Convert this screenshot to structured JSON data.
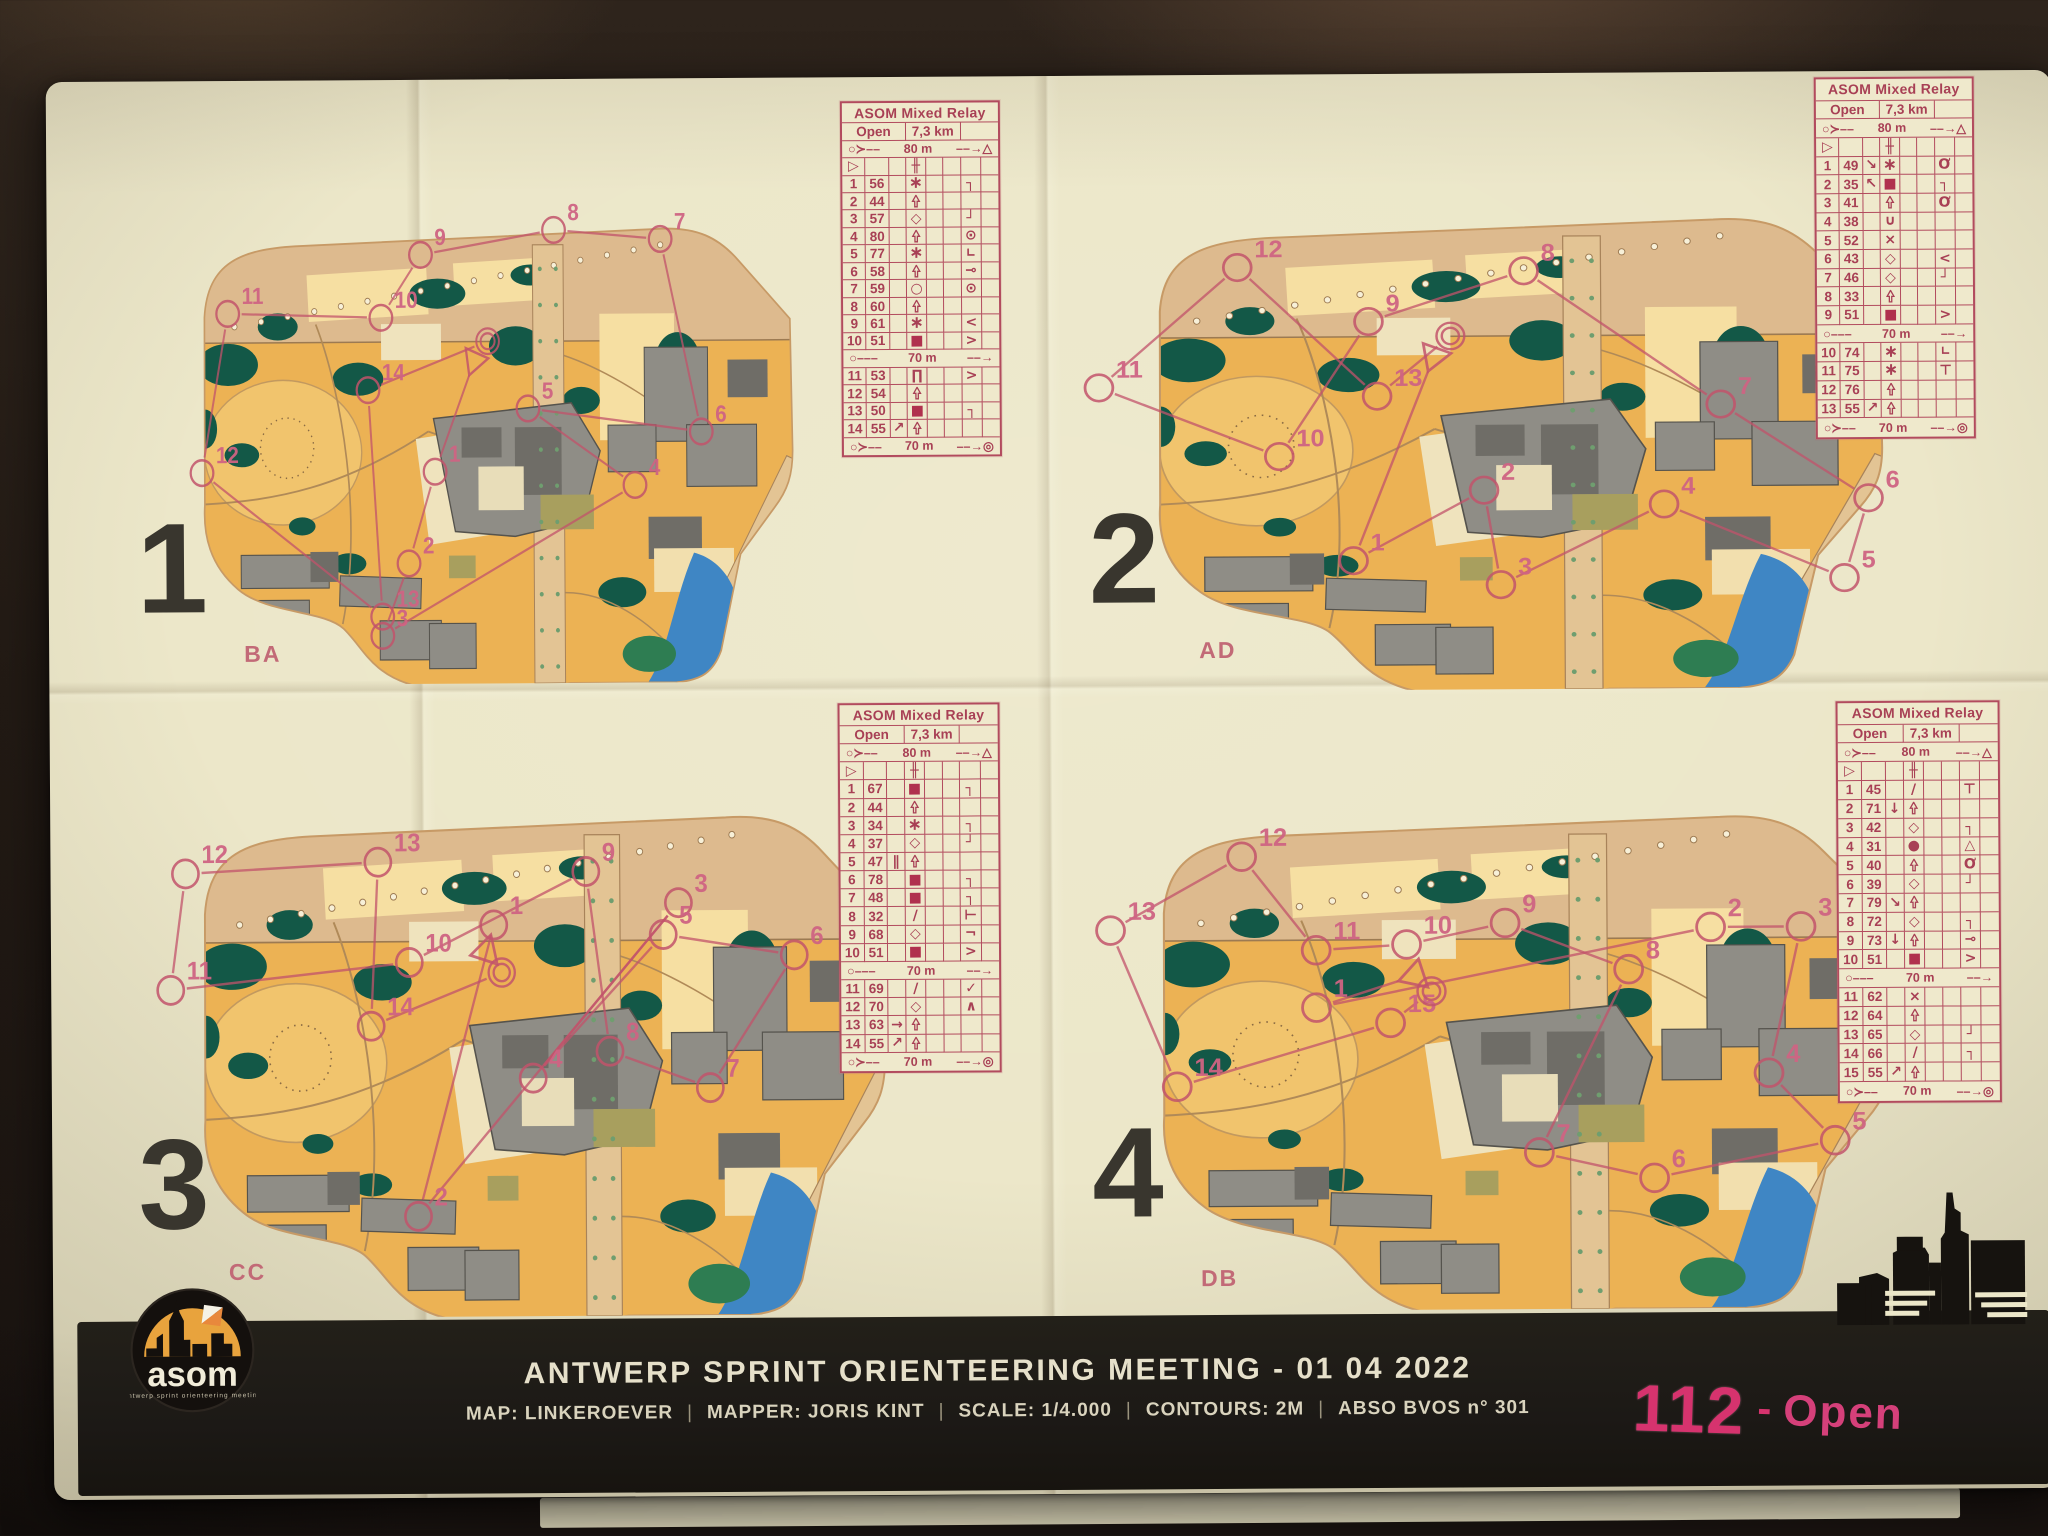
{
  "colors": {
    "course_magenta": "#c2536b",
    "table_magenta": "#a84055",
    "bib_pink": "#d6336e",
    "paper_cream": "#ece7c9",
    "map_orange": "#ecb254",
    "map_green": "#135847",
    "building_gray": "#8f8d86",
    "water_blue": "#3f86c4",
    "footer_black": "#1c1916"
  },
  "event": {
    "title_line": "ANTWERP SPRINT ORIENTEERING MEETING - 01 04 2022",
    "meta_items": [
      "MAP: LINKEROEVER",
      "MAPPER: JORIS KINT",
      "SCALE: 1/4.000",
      "CONTOURS: 2M",
      "ABSO BVOS n° 301"
    ],
    "meta_separator": "|",
    "bib_number": "112",
    "bib_separator": "-",
    "bib_class": "Open",
    "logo_text": "asom",
    "logo_tagline": "antwerp sprint orienteering meeting"
  },
  "relay": {
    "table_title": "ASOM Mixed Relay",
    "class_name": "Open",
    "course_length": "7,3 km",
    "start_distance": "80 m",
    "exchange_distance": "70 m",
    "finish_distance": "70 m"
  },
  "panels": [
    {
      "leg": "1",
      "map_code": "BA",
      "divider_after": 10,
      "controls": [
        {
          "n": "1",
          "code": "56",
          "d": "star",
          "g": "corner-ne"
        },
        {
          "n": "2",
          "code": "44",
          "d": "tree"
        },
        {
          "n": "3",
          "code": "57",
          "d": "diamond",
          "g": "corner-se"
        },
        {
          "n": "4",
          "code": "80",
          "d": "tree",
          "g": "circle-tick"
        },
        {
          "n": "5",
          "code": "77",
          "d": "star",
          "g": "corner"
        },
        {
          "n": "6",
          "code": "58",
          "d": "tree",
          "g": "circle-line"
        },
        {
          "n": "7",
          "code": "59",
          "d": "circle",
          "g": "circle-tick"
        },
        {
          "n": "8",
          "code": "60",
          "d": "tree"
        },
        {
          "n": "9",
          "code": "61",
          "d": "star",
          "g": "bend-w"
        },
        {
          "n": "10",
          "code": "51",
          "d": "square",
          "g": "bend-e"
        },
        {
          "n": "11",
          "code": "53",
          "d": "canopy",
          "g": "bend-e"
        },
        {
          "n": "12",
          "code": "54",
          "d": "tree"
        },
        {
          "n": "13",
          "code": "50",
          "d": "square",
          "g": "corner-ne"
        },
        {
          "n": "14",
          "code": "55",
          "c": "arrow-ne",
          "d": "tree"
        }
      ],
      "course": {
        "start": [
          50,
          33
        ],
        "finish": [
          52,
          29
        ],
        "points": [
          [
            1,
            44,
            56
          ],
          [
            2,
            40,
            75
          ],
          [
            3,
            36,
            90
          ],
          [
            4,
            74,
            59
          ],
          [
            5,
            58,
            43
          ],
          [
            6,
            84,
            48
          ],
          [
            7,
            78,
            8
          ],
          [
            8,
            62,
            6
          ],
          [
            9,
            42,
            11
          ],
          [
            10,
            36,
            24
          ],
          [
            11,
            13,
            23
          ],
          [
            12,
            9,
            56
          ],
          [
            13,
            36,
            86
          ],
          [
            14,
            34,
            39
          ]
        ]
      }
    },
    {
      "leg": "2",
      "map_code": "AD",
      "divider_after": 9,
      "controls": [
        {
          "n": "1",
          "code": "49",
          "c": "arrow-se",
          "d": "star",
          "g": "circle-tail"
        },
        {
          "n": "2",
          "code": "35",
          "c": "arrow-nw",
          "d": "square",
          "g": "corner-ne"
        },
        {
          "n": "3",
          "code": "41",
          "d": "tree",
          "g": "circle-tail"
        },
        {
          "n": "4",
          "code": "38",
          "d": "semicircle"
        },
        {
          "n": "5",
          "code": "52",
          "d": "cross"
        },
        {
          "n": "6",
          "code": "43",
          "d": "diamond",
          "g": "bend-w"
        },
        {
          "n": "7",
          "code": "46",
          "d": "diamond",
          "g": "corner-se"
        },
        {
          "n": "8",
          "code": "33",
          "d": "tree"
        },
        {
          "n": "9",
          "code": "51",
          "d": "square",
          "g": "bend-e"
        },
        {
          "n": "10",
          "code": "74",
          "d": "star",
          "g": "corner"
        },
        {
          "n": "11",
          "code": "75",
          "d": "star",
          "g": "t-n"
        },
        {
          "n": "12",
          "code": "76",
          "d": "tree"
        },
        {
          "n": "13",
          "code": "55",
          "c": "arrow-ne",
          "d": "tree"
        }
      ],
      "course": {
        "start": [
          43,
          33
        ],
        "finish": [
          45,
          29
        ],
        "points": [
          [
            1,
            33,
            74
          ],
          [
            2,
            49,
            60
          ],
          [
            3,
            51,
            79
          ],
          [
            4,
            71,
            63
          ],
          [
            5,
            93,
            78
          ],
          [
            6,
            96,
            62
          ],
          [
            7,
            78,
            43
          ],
          [
            8,
            54,
            16
          ],
          [
            9,
            35,
            26
          ],
          [
            10,
            24,
            53
          ],
          [
            11,
            2,
            39
          ],
          [
            12,
            19,
            15
          ],
          [
            13,
            36,
            41
          ]
        ]
      }
    },
    {
      "leg": "3",
      "map_code": "CC",
      "divider_after": 10,
      "controls": [
        {
          "n": "1",
          "code": "67",
          "d": "square",
          "g": "corner-ne"
        },
        {
          "n": "2",
          "code": "44",
          "d": "tree"
        },
        {
          "n": "3",
          "code": "34",
          "d": "star",
          "g": "corner-ne"
        },
        {
          "n": "4",
          "code": "37",
          "d": "diamond",
          "g": "corner-se"
        },
        {
          "n": "5",
          "code": "47",
          "c": "between",
          "d": "tree"
        },
        {
          "n": "6",
          "code": "78",
          "d": "square",
          "g": "corner-ne"
        },
        {
          "n": "7",
          "code": "48",
          "d": "square",
          "g": "corner-ne"
        },
        {
          "n": "8",
          "code": "32",
          "d": "slash",
          "g": "t-w"
        },
        {
          "n": "9",
          "code": "68",
          "d": "diamond",
          "g": "not"
        },
        {
          "n": "10",
          "code": "51",
          "d": "square",
          "g": "bend-e"
        },
        {
          "n": "11",
          "code": "69",
          "d": "slash",
          "g": "junction"
        },
        {
          "n": "12",
          "code": "70",
          "d": "diamond",
          "g": "caret"
        },
        {
          "n": "13",
          "code": "63",
          "c": "arrow-e",
          "d": "tree"
        },
        {
          "n": "14",
          "code": "55",
          "c": "arrow-ne",
          "d": "tree"
        }
      ],
      "course": {
        "start": [
          46,
          31
        ],
        "finish": [
          48,
          35
        ],
        "points": [
          [
            1,
            47,
            26
          ],
          [
            2,
            37,
            81
          ],
          [
            3,
            71,
            22
          ],
          [
            4,
            52,
            55
          ],
          [
            5,
            69,
            28
          ],
          [
            6,
            86,
            32
          ],
          [
            7,
            75,
            57
          ],
          [
            8,
            62,
            50
          ],
          [
            9,
            59,
            16
          ],
          [
            10,
            36,
            33
          ],
          [
            11,
            5,
            38
          ],
          [
            12,
            7,
            16
          ],
          [
            13,
            32,
            14
          ],
          [
            14,
            31,
            45
          ]
        ]
      }
    },
    {
      "leg": "4",
      "map_code": "DB",
      "divider_after": 10,
      "controls": [
        {
          "n": "1",
          "code": "45",
          "d": "slash",
          "g": "t-n"
        },
        {
          "n": "2",
          "code": "71",
          "c": "arrow-s",
          "d": "tree"
        },
        {
          "n": "3",
          "code": "42",
          "d": "diamond",
          "g": "corner-ne"
        },
        {
          "n": "4",
          "code": "31",
          "d": "dot",
          "g": "triangle"
        },
        {
          "n": "5",
          "code": "40",
          "d": "tree",
          "g": "circle-tail"
        },
        {
          "n": "6",
          "code": "39",
          "d": "diamond",
          "g": "corner-se"
        },
        {
          "n": "7",
          "code": "79",
          "c": "arrow-se",
          "d": "tree"
        },
        {
          "n": "8",
          "code": "72",
          "d": "diamond",
          "g": "corner-ne"
        },
        {
          "n": "9",
          "code": "73",
          "c": "arrow-s",
          "d": "tree",
          "g": "circle-line"
        },
        {
          "n": "10",
          "code": "51",
          "d": "square",
          "g": "bend-e"
        },
        {
          "n": "11",
          "code": "62",
          "d": "cross"
        },
        {
          "n": "12",
          "code": "64",
          "d": "tree"
        },
        {
          "n": "13",
          "code": "65",
          "d": "diamond",
          "g": "corner-se"
        },
        {
          "n": "14",
          "code": "66",
          "d": "slash",
          "g": "corner-ne"
        },
        {
          "n": "15",
          "code": "55",
          "c": "arrow-ne",
          "d": "tree"
        }
      ],
      "course": {
        "start": [
          40,
          36
        ],
        "finish": [
          42,
          39
        ],
        "points": [
          [
            1,
            28,
            42
          ],
          [
            2,
            76,
            27
          ],
          [
            3,
            87,
            27
          ],
          [
            4,
            83,
            55
          ],
          [
            5,
            91,
            68
          ],
          [
            6,
            69,
            75
          ],
          [
            7,
            55,
            70
          ],
          [
            8,
            66,
            35
          ],
          [
            9,
            51,
            26
          ],
          [
            10,
            39,
            30
          ],
          [
            11,
            28,
            31
          ],
          [
            12,
            19,
            13
          ],
          [
            13,
            3,
            27
          ],
          [
            14,
            11,
            57
          ],
          [
            15,
            37,
            45
          ]
        ]
      }
    }
  ]
}
